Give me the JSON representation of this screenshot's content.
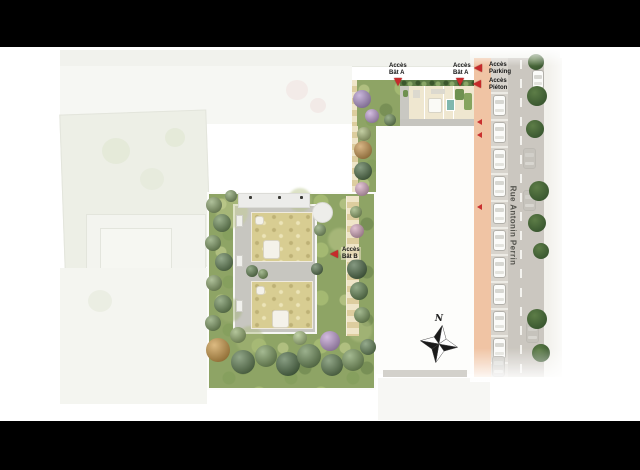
{
  "street": {
    "name": "Rue Antonin Perrin"
  },
  "compass": {
    "label": "N"
  },
  "access_labels": {
    "bat_a_1": {
      "line1": "Accès",
      "line2": "Bât A"
    },
    "bat_a_2": {
      "line1": "Accès",
      "line2": "Bât A"
    },
    "parking": {
      "line1": "Accès",
      "line2": "Parking"
    },
    "pieton": {
      "line1": "Accès",
      "line2": "Piéton"
    },
    "bat_b": {
      "line1": "Accès",
      "line2": "Bât B"
    }
  },
  "palette": {
    "arrow_red": "#c62a2b",
    "garden_green": "#8ea465",
    "roof_tan": "#d8cd92",
    "street_asphalt": "#cbc7c0",
    "sidewalk_salmon": "#f0c4a4",
    "letterbox": "#000000"
  },
  "scene": {
    "garden_trees": [
      {
        "x": 214,
        "y": 205,
        "r": 8,
        "c": "#7f9b5d"
      },
      {
        "x": 222,
        "y": 223,
        "r": 9,
        "c": "#5f8148"
      },
      {
        "x": 213,
        "y": 243,
        "r": 8,
        "c": "#6f8f52"
      },
      {
        "x": 224,
        "y": 262,
        "r": 9,
        "c": "#527444"
      },
      {
        "x": 214,
        "y": 283,
        "r": 8,
        "c": "#7f9b5d"
      },
      {
        "x": 223,
        "y": 304,
        "r": 9,
        "c": "#5f8148"
      },
      {
        "x": 213,
        "y": 323,
        "r": 8,
        "c": "#6f8f52"
      },
      {
        "x": 218,
        "y": 350,
        "r": 12,
        "c": "#c79035"
      },
      {
        "x": 243,
        "y": 362,
        "r": 12,
        "c": "#4f7040"
      },
      {
        "x": 266,
        "y": 356,
        "r": 11,
        "c": "#6d8f4e"
      },
      {
        "x": 288,
        "y": 364,
        "r": 12,
        "c": "#3f6136"
      },
      {
        "x": 309,
        "y": 356,
        "r": 12,
        "c": "#5e8047"
      },
      {
        "x": 330,
        "y": 341,
        "r": 10,
        "c": "#b893cc"
      },
      {
        "x": 332,
        "y": 365,
        "r": 11,
        "c": "#4f7040"
      },
      {
        "x": 353,
        "y": 360,
        "r": 11,
        "c": "#6d8f4e"
      },
      {
        "x": 368,
        "y": 347,
        "r": 8,
        "c": "#557747"
      },
      {
        "x": 362,
        "y": 99,
        "r": 9,
        "c": "#a98bc6"
      },
      {
        "x": 372,
        "y": 116,
        "r": 7,
        "c": "#bb97cf"
      },
      {
        "x": 390,
        "y": 120,
        "r": 6,
        "c": "#5f8148"
      },
      {
        "x": 364,
        "y": 134,
        "r": 7,
        "c": "#9fb06a"
      },
      {
        "x": 363,
        "y": 150,
        "r": 9,
        "c": "#c08a3c"
      },
      {
        "x": 363,
        "y": 171,
        "r": 9,
        "c": "#3f6136"
      },
      {
        "x": 362,
        "y": 189,
        "r": 7,
        "c": "#d4a3bd"
      },
      {
        "x": 356,
        "y": 212,
        "r": 6,
        "c": "#84a05c"
      },
      {
        "x": 357,
        "y": 231,
        "r": 7,
        "c": "#cf9db4"
      },
      {
        "x": 357,
        "y": 269,
        "r": 10,
        "c": "#3a5a33"
      },
      {
        "x": 359,
        "y": 291,
        "r": 9,
        "c": "#51753f"
      },
      {
        "x": 362,
        "y": 315,
        "r": 8,
        "c": "#6d8f4e"
      },
      {
        "x": 238,
        "y": 335,
        "r": 8,
        "c": "#87a35e"
      },
      {
        "x": 300,
        "y": 338,
        "r": 7,
        "c": "#9db873"
      },
      {
        "x": 252,
        "y": 271,
        "r": 6,
        "c": "#537541"
      },
      {
        "x": 263,
        "y": 274,
        "r": 5,
        "c": "#6d8f4e"
      },
      {
        "x": 317,
        "y": 269,
        "r": 6,
        "c": "#46643c"
      },
      {
        "x": 320,
        "y": 230,
        "r": 6,
        "c": "#77955a"
      },
      {
        "x": 231,
        "y": 196,
        "r": 6,
        "c": "#77955a"
      }
    ],
    "ground_blobs": [
      {
        "x": 232,
        "y": 212,
        "r": 16,
        "c": "#c3cd90"
      },
      {
        "x": 300,
        "y": 200,
        "r": 12,
        "c": "#b4c184"
      },
      {
        "x": 340,
        "y": 240,
        "r": 12,
        "c": "#c3cd90"
      },
      {
        "x": 250,
        "y": 340,
        "r": 14,
        "c": "#aab97a"
      },
      {
        "x": 360,
        "y": 330,
        "r": 12,
        "c": "#b7c488"
      },
      {
        "x": 230,
        "y": 310,
        "r": 12,
        "c": "#a1b275"
      }
    ],
    "street_trees": [
      {
        "x": 536,
        "y": 62,
        "r": 8
      },
      {
        "x": 537,
        "y": 96,
        "r": 10
      },
      {
        "x": 535,
        "y": 129,
        "r": 9
      },
      {
        "x": 539,
        "y": 191,
        "r": 10
      },
      {
        "x": 537,
        "y": 223,
        "r": 9
      },
      {
        "x": 541,
        "y": 251,
        "r": 8
      },
      {
        "x": 537,
        "y": 319,
        "r": 10
      },
      {
        "x": 541,
        "y": 353,
        "r": 9
      }
    ],
    "parked_car_slots": [
      92,
      119,
      146,
      173,
      200,
      227,
      254,
      281,
      308,
      335
    ],
    "ghost_cars": [
      {
        "x": 523,
        "y": 148
      },
      {
        "x": 523,
        "y": 190
      },
      {
        "x": 526,
        "y": 322
      }
    ],
    "red_chevrons": [
      {
        "x": 477,
        "y": 119
      },
      {
        "x": 477,
        "y": 132
      },
      {
        "x": 477,
        "y": 204
      }
    ]
  }
}
